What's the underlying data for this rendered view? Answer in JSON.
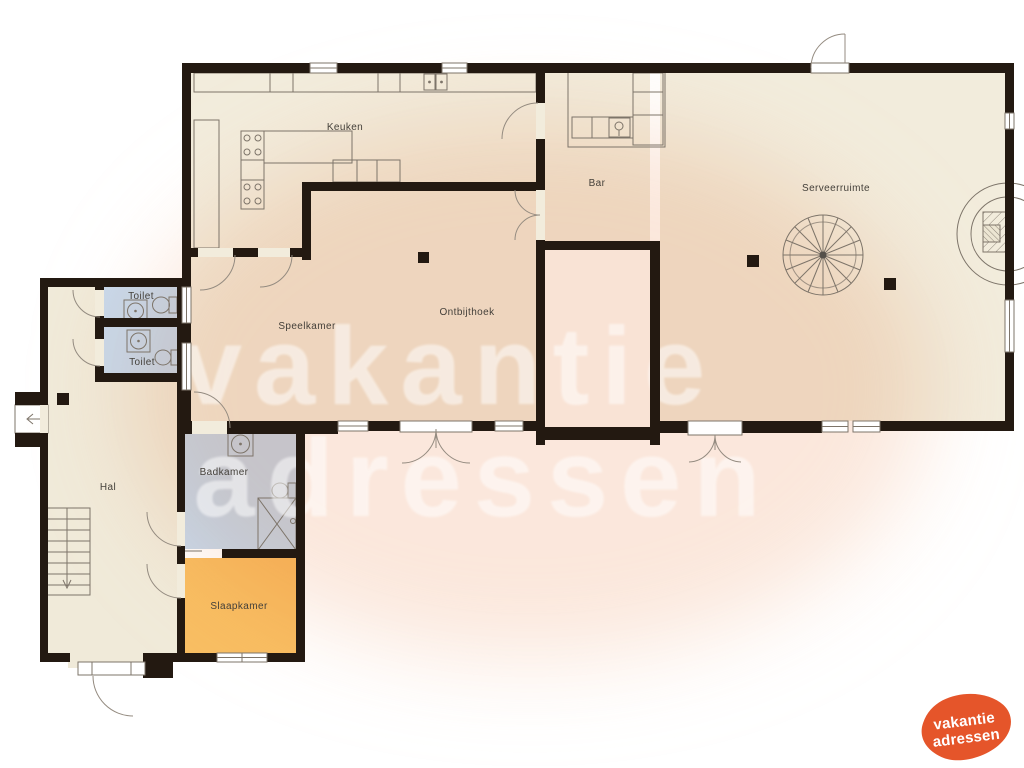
{
  "rooms": {
    "keuken": {
      "label": "Keuken"
    },
    "bar": {
      "label": "Bar"
    },
    "serveerruimte": {
      "label": "Serveerruimte"
    },
    "speelkamer": {
      "label": "Speelkamer"
    },
    "ontbijthoek": {
      "label": "Ontbijthoek"
    },
    "toilet_top": {
      "label": "Toilet"
    },
    "toilet_bottom": {
      "label": "Toilet"
    },
    "badkamer": {
      "label": "Badkamer"
    },
    "hal": {
      "label": "Hal"
    },
    "slaapkamer": {
      "label": "Slaapkamer"
    }
  },
  "watermark": {
    "line1": "vakantie",
    "line2": "adressen"
  },
  "logo": {
    "line1": "vakantie",
    "line2": "adressen"
  },
  "colors": {
    "wall": "#231911",
    "floor": "#f2ecdc",
    "floor_hal": "#f0ead9",
    "floor_wet": "#c9d9eb",
    "floor_bedroom": "#f8be62",
    "floor_void": "#fdfbf7",
    "peach_tint": "#f6cab0",
    "logo_orange": "#e5552a",
    "line": "#7d7469",
    "label_text": "#44403a",
    "watermark_white": "#ffffff"
  }
}
